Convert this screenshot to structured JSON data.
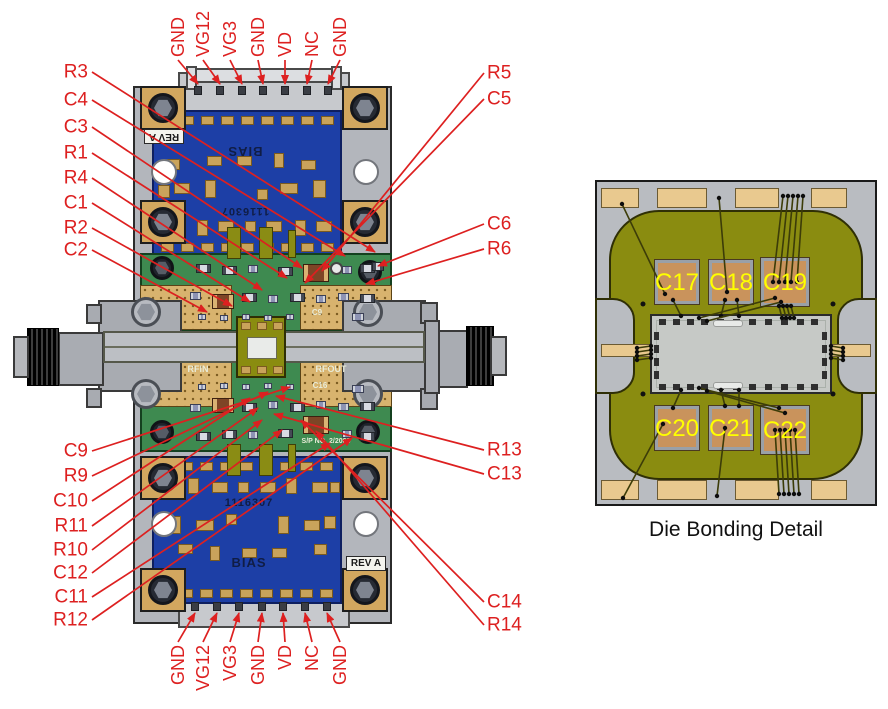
{
  "colors": {
    "callout_red": "#dd2020",
    "pcb_blue": "#1d3fa6",
    "pcb_green": "#3e8a50",
    "pad_tan": "#c9a35b",
    "metal_gray": "#b3b6bc",
    "olive": "#8a8c10",
    "cap_copper": "#c9935c",
    "cap_label_yellow": "#ffff00"
  },
  "silkscreen": {
    "bias": "BIAS",
    "part_number": "1116307",
    "rev": "REV A",
    "rfin": "RFIN",
    "rfout": "RFOUT",
    "c9": "C9",
    "c16": "C16",
    "sp_no": "S/P NO. 2/2008"
  },
  "pins": {
    "top": {
      "labels": [
        "GND",
        "VG12",
        "VG3",
        "GND",
        "VD",
        "NC",
        "GND"
      ],
      "label_x": [
        178,
        203,
        230,
        258,
        285,
        312,
        340
      ],
      "pin_x": [
        198,
        220,
        242,
        263,
        285,
        307,
        328
      ],
      "text_y": 57,
      "pin_y": 84
    },
    "bottom": {
      "labels": [
        "GND",
        "VG12",
        "VG3",
        "GND",
        "VD",
        "NC",
        "GND"
      ],
      "label_x": [
        178,
        203,
        230,
        258,
        285,
        312,
        340
      ],
      "pin_x": [
        195,
        217,
        239,
        262,
        283,
        305,
        327
      ],
      "text_y": 645,
      "pin_y": 613
    }
  },
  "callouts": {
    "left_top": [
      {
        "label": "R3",
        "lx": 88,
        "ly": 72,
        "tx": 375,
        "ty": 252
      },
      {
        "label": "C4",
        "lx": 88,
        "ly": 100,
        "tx": 345,
        "ty": 256
      },
      {
        "label": "C3",
        "lx": 88,
        "ly": 127,
        "tx": 302,
        "ty": 268
      },
      {
        "label": "R1",
        "lx": 88,
        "ly": 153,
        "tx": 287,
        "ty": 278
      },
      {
        "label": "R4",
        "lx": 88,
        "ly": 178,
        "tx": 262,
        "ty": 290
      },
      {
        "label": "C1",
        "lx": 88,
        "ly": 203,
        "tx": 250,
        "ty": 302
      },
      {
        "label": "R2",
        "lx": 88,
        "ly": 228,
        "tx": 232,
        "ty": 306
      },
      {
        "label": "C2",
        "lx": 88,
        "ly": 250,
        "tx": 207,
        "ty": 312
      }
    ],
    "left_bottom": [
      {
        "label": "C9",
        "lx": 88,
        "ly": 451,
        "tx": 290,
        "ty": 387
      },
      {
        "label": "R9",
        "lx": 88,
        "ly": 476,
        "tx": 268,
        "ty": 392
      },
      {
        "label": "C10",
        "lx": 88,
        "ly": 501,
        "tx": 250,
        "ty": 398
      },
      {
        "label": "R11",
        "lx": 88,
        "ly": 526,
        "tx": 258,
        "ty": 408
      },
      {
        "label": "R10",
        "lx": 88,
        "ly": 550,
        "tx": 262,
        "ty": 420
      },
      {
        "label": "C12",
        "lx": 88,
        "ly": 573,
        "tx": 282,
        "ty": 430
      },
      {
        "label": "C11",
        "lx": 88,
        "ly": 597,
        "tx": 330,
        "ty": 443
      },
      {
        "label": "R12",
        "lx": 88,
        "ly": 620,
        "tx": 352,
        "ty": 438
      }
    ],
    "right_top": [
      {
        "label": "R5",
        "lx": 487,
        "ly": 73,
        "tx": 322,
        "ty": 271
      },
      {
        "label": "C5",
        "lx": 487,
        "ly": 99,
        "tx": 305,
        "ty": 283
      },
      {
        "label": "C6",
        "lx": 487,
        "ly": 224,
        "tx": 378,
        "ty": 266
      },
      {
        "label": "R6",
        "lx": 487,
        "ly": 249,
        "tx": 366,
        "ty": 284
      }
    ],
    "right_bottom": [
      {
        "label": "R13",
        "lx": 487,
        "ly": 450,
        "tx": 276,
        "ty": 396
      },
      {
        "label": "C13",
        "lx": 487,
        "ly": 474,
        "tx": 274,
        "ty": 414
      },
      {
        "label": "C14",
        "lx": 487,
        "ly": 602,
        "tx": 301,
        "ty": 420
      },
      {
        "label": "R14",
        "lx": 487,
        "ly": 625,
        "tx": 316,
        "ty": 431
      }
    ]
  },
  "die_detail": {
    "caption": "Die Bonding Detail",
    "cap_labels": [
      "C17",
      "C18",
      "C19",
      "C20",
      "C21",
      "C22"
    ]
  }
}
